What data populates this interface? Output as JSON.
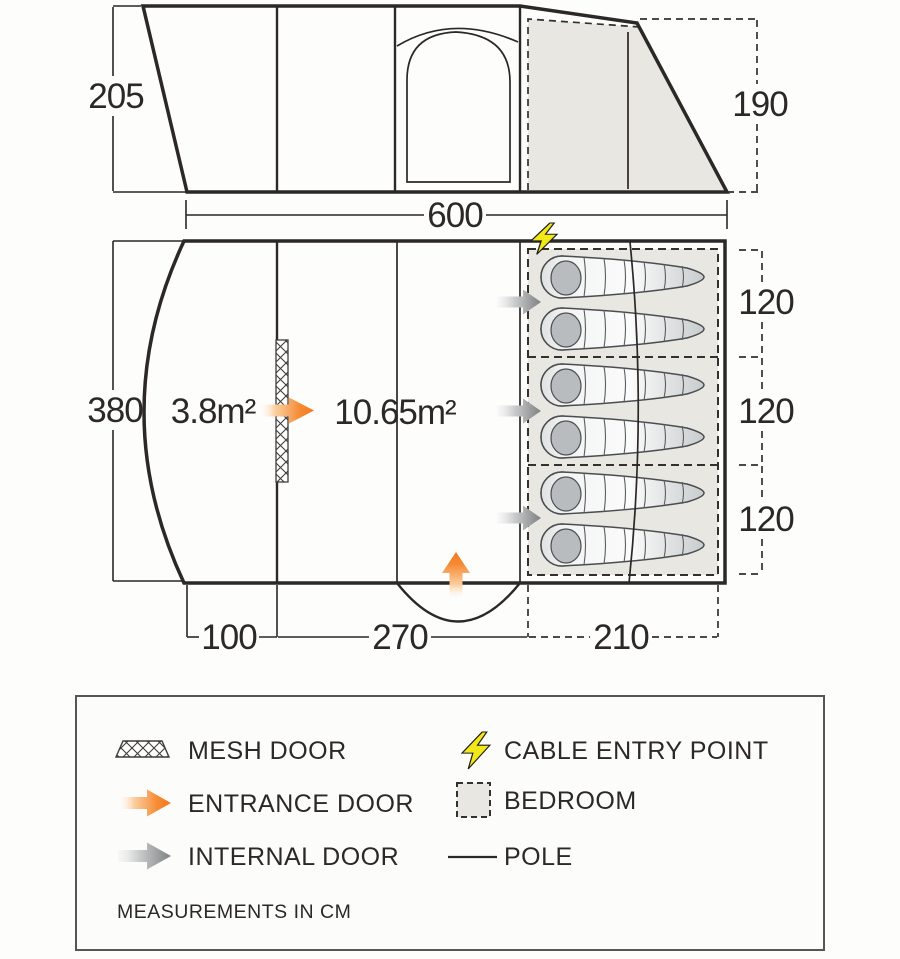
{
  "side_view": {
    "height_front": "205",
    "height_rear": "190",
    "length": "600"
  },
  "floor_plan": {
    "width": "380",
    "porch_area": "3.8m²",
    "living_area": "10.65m²",
    "porch_depth": "100",
    "living_depth": "270",
    "bedroom_depth": "210",
    "bedroom_widths": [
      "120",
      "120",
      "120"
    ]
  },
  "legend": {
    "mesh_door": "MESH DOOR",
    "entrance_door": "ENTRANCE DOOR",
    "internal_door": "INTERNAL DOOR",
    "cable_entry": "CABLE ENTRY POINT",
    "bedroom": "BEDROOM",
    "pole": "POLE",
    "note": "MEASUREMENTS IN CM"
  },
  "colors": {
    "entrance_orange": "#f4791f",
    "internal_grey": "#7e8183",
    "cable_yellow": "#f2e818",
    "bedroom_fill": "#e8e7e2",
    "line": "#2b2826"
  }
}
